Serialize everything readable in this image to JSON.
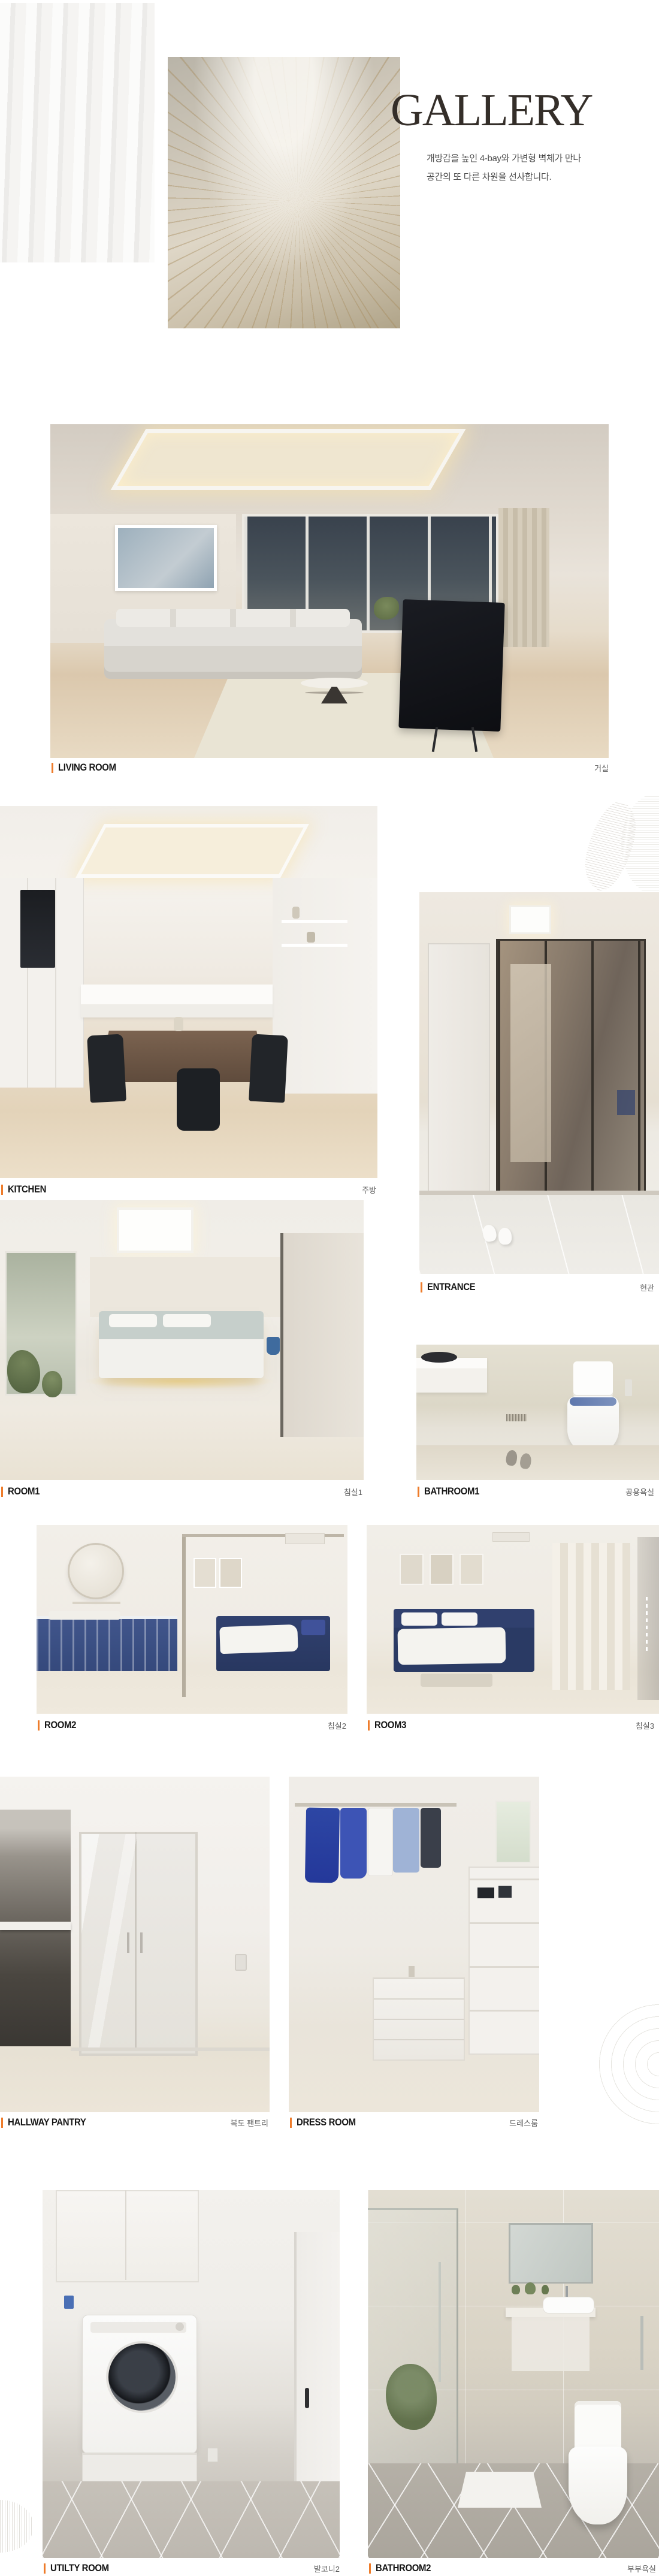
{
  "accent_color": "#ee7c2b",
  "header": {
    "title": "GALLERY",
    "subtitle_line1": "개방감을 높인 4-bay와 가변형 벽체가 만나",
    "subtitle_line2": "공간의 또 다른 차원을 선사합니다."
  },
  "sections": [
    {
      "id": "living-room",
      "label_en": "LIVING ROOM",
      "label_kr": "거실"
    },
    {
      "id": "kitchen",
      "label_en": "KITCHEN",
      "label_kr": "주방"
    },
    {
      "id": "entrance",
      "label_en": "ENTRANCE",
      "label_kr": "현관"
    },
    {
      "id": "room1",
      "label_en": "ROOM1",
      "label_kr": "침실1"
    },
    {
      "id": "bathroom1",
      "label_en": "BATHROOM1",
      "label_kr": "공용욕실"
    },
    {
      "id": "room2",
      "label_en": "ROOM2",
      "label_kr": "침실2"
    },
    {
      "id": "room3",
      "label_en": "ROOM3",
      "label_kr": "침실3"
    },
    {
      "id": "hallway-pantry",
      "label_en": "HALLWAY PANTRY",
      "label_kr": "복도 팬트리"
    },
    {
      "id": "dress-room",
      "label_en": "DRESS ROOM",
      "label_kr": "드레스룸"
    },
    {
      "id": "utility-room",
      "label_en": "UTILTY ROOM",
      "label_kr": "발코니2"
    },
    {
      "id": "bathroom2",
      "label_en": "BATHROOM2",
      "label_kr": "부부욕실"
    }
  ]
}
